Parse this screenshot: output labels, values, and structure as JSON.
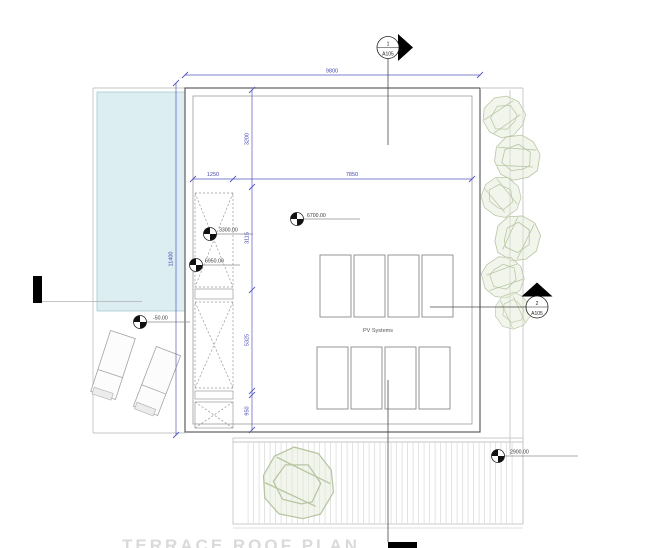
{
  "labels": {
    "pv_systems": "PV Systems",
    "sheet_title": "TERRACE ROOF PLAN"
  },
  "section_markers": {
    "top": {
      "number": "1",
      "sheet": "A105"
    },
    "right": {
      "number": "2",
      "sheet": "A105"
    }
  },
  "dimensions": {
    "overall_width": "9800",
    "overall_height": "11400",
    "left_offset": "1250",
    "main_width": "7850",
    "seg_top": "3200",
    "seg_mid1": "3115",
    "seg_mid2": "5325",
    "seg_bottom": "950"
  },
  "spot_elevations": {
    "main_roof": "6700.00",
    "stair_mid": "3300.00",
    "stair_top": "6950.00",
    "pool_deck": "-50.00",
    "rear_terrace": "2900.00"
  },
  "colors": {
    "dimension_blue": "#5456bd",
    "pool_fill": "#dceef1",
    "pool_border": "#aac9cf",
    "tree_green": "#b7c6a2",
    "line_dark": "#5f5f5f",
    "line_light": "#c6c6c6"
  }
}
